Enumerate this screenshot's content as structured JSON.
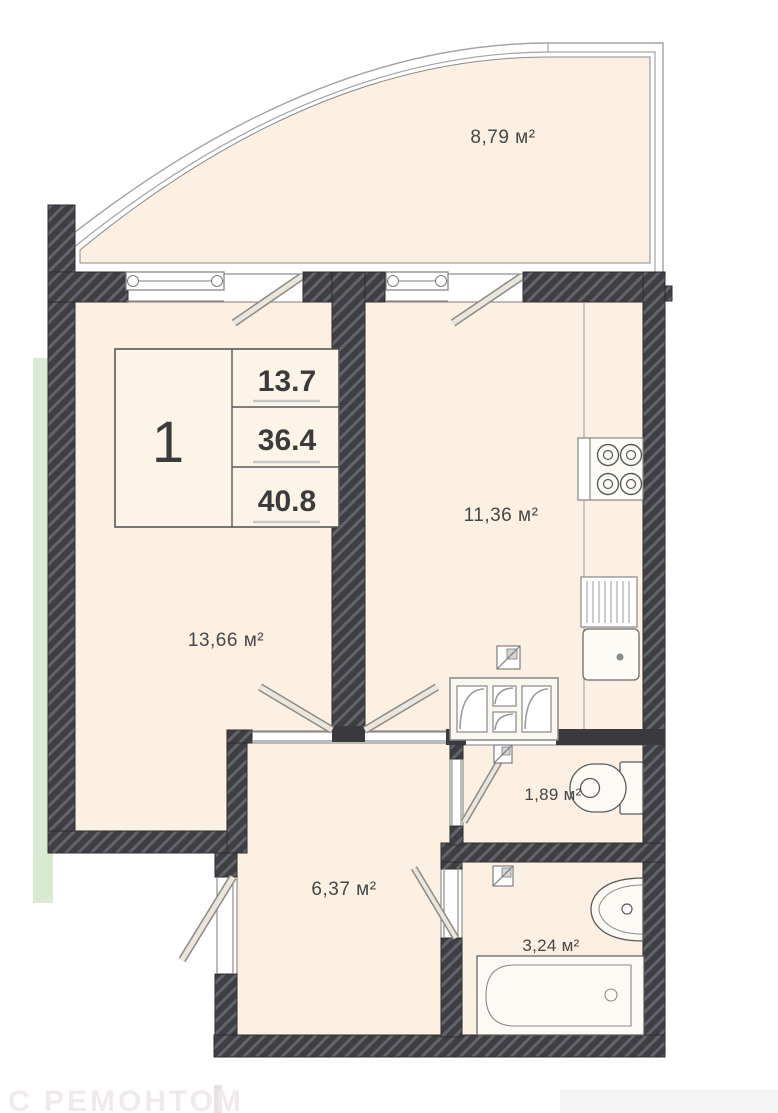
{
  "plan": {
    "type": "apartment-floor-plan",
    "rooms": {
      "balcony": {
        "name": "balcony",
        "area_label": "8,79 м²"
      },
      "living": {
        "name": "living-room",
        "area_label": "13,66 м²"
      },
      "kitchen": {
        "name": "kitchen",
        "area_label": "11,36 м²"
      },
      "wc": {
        "name": "wc",
        "area_label": "1,89 м²"
      },
      "hallway": {
        "name": "hallway",
        "area_label": "6,37 м²"
      },
      "bathroom": {
        "name": "bathroom",
        "area_label": "3,24 м²"
      }
    },
    "stamp": {
      "room_count": "1",
      "living_area": "13.7",
      "apartment_area": "36.4",
      "total_area": "40.8"
    },
    "watermark": "С РЕМОНТОМ",
    "colors": {
      "room_fill": "#fbf0e2",
      "wall": "#3e3e43",
      "wall_hatch": "#63636b",
      "accent_green": "#d9ead3",
      "line": "#8f8f8f",
      "label_text": "#474747"
    }
  }
}
